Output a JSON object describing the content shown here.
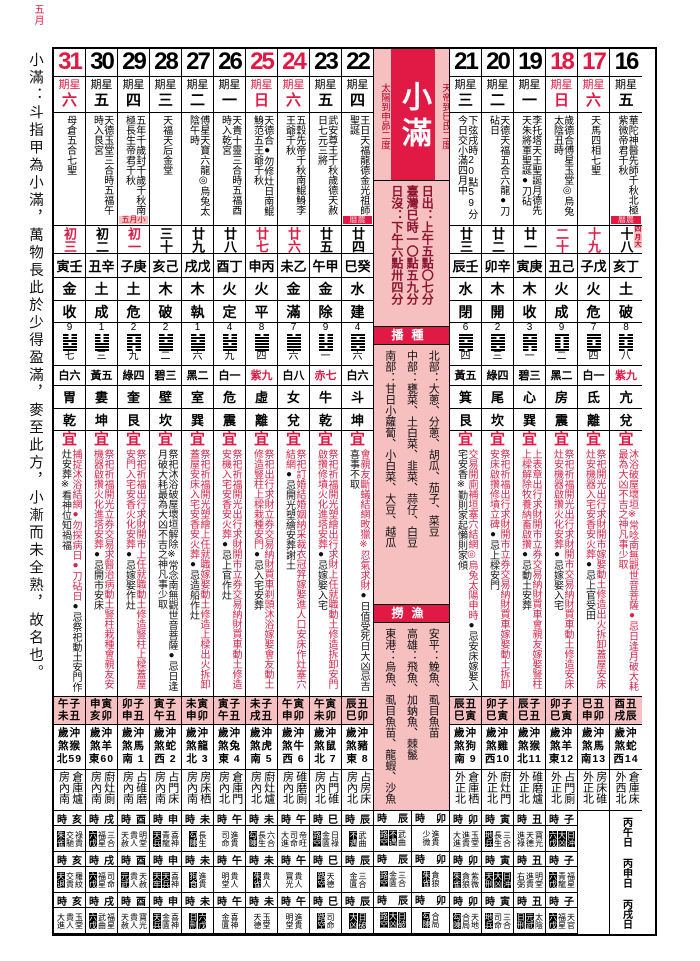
{
  "corner_label": "五月",
  "sidebar": {
    "text": "小滿：斗指甲為小滿，萬物長此於少得盈滿，麥至此方，小漸而未全熟，故名也。"
  },
  "center": {
    "title": "小滿",
    "right_label": "天帝到巳氐二度",
    "left_label": "太陽到申昴二度",
    "sun_lines": [
      "日出：上午五點〇七分",
      "臺灣巳時一〇點五九分",
      "日沒：下午六點卅四分"
    ],
    "sow_header": "播種",
    "crops": [
      "北部：大蔥、分蔥、胡瓜、茄子、菜豆",
      "中部：甕菜、土白菜、韭菜、蒜仔、白豆",
      "南部：甘日小蘿蔔、小白菜、大豆、越瓜"
    ],
    "fish_header": "撈漁",
    "fish": [
      "安平：鮸魚、虱目魚苗",
      "高雄：飛魚、加蚋魚、棘鬣",
      "東港：烏魚、虱目魚苗、龍蝦、沙魚"
    ],
    "bottom": [
      {
        "hour": "辰",
        "bands": [
          [
            "路空",
            "不遇",
            "武曲"
          ],
          [
            "路空",
            "金匱",
            "三合"
          ],
          [
            "路空",
            "大凶",
            "日破"
          ]
        ]
      },
      {
        "hour": "卯",
        "bands": [
          [
            "少微",
            "進貴"
          ],
          [
            "朱雀",
            "貪狼"
          ],
          [
            "勾陳",
            "合局"
          ]
        ]
      }
    ]
  },
  "inauspicious_stars": [
    "朱雀",
    "天兵",
    "天牢",
    "元武",
    "勾陳",
    "日刑",
    "狗食",
    "路空",
    "不遇",
    "大凶",
    "日破",
    "日沖",
    "天刑",
    "地兵",
    "天退",
    "六戊"
  ],
  "columns": [
    {
      "date": "31",
      "weekday": "六",
      "red": true,
      "festivals": "母倉五合七聖",
      "tag": null,
      "lunar": "初三",
      "lunar_red": true,
      "ganzhi": "寅壬",
      "element": "金",
      "officer": "收",
      "num": "9",
      "hex_num": "七",
      "star": "白六",
      "star_red": false,
      "mansion": "胃",
      "trigram": "乾",
      "yi_r": "捕捉沐浴結網●勿探病日●刀砧日",
      "yi_b": "●忌祭祀動土安門作灶安葬※看神位知禍福",
      "jishi": [
        "午子",
        "未丑"
      ],
      "chong": [
        "歲沖",
        "煞猴",
        "北59"
      ],
      "taishen": "倉庫爐房內南",
      "hour": "亥",
      "bands": [
        [
          "朱雀",
          "交馳",
          "祿貴"
        ],
        [
          "天退",
          "交貴",
          "羅紋"
        ],
        [
          "大進",
          "貴人",
          "玉堂"
        ]
      ]
    },
    {
      "date": "30",
      "weekday": "五",
      "red": false,
      "festivals": "天德玉堂三合時五福午時入艮宮",
      "tag": null,
      "lunar": "初二",
      "lunar_red": false,
      "ganzhi": "丑辛",
      "element": "土",
      "officer": "成",
      "num": "1",
      "hex_num": "三",
      "star": "黃五",
      "star_red": false,
      "mansion": "婁",
      "trigram": "坤",
      "yi_r": "祭祀祈福開光立券交易求醫治病動土豎柱栽種會親友安機器啟攢火化進塔安葬",
      "yi_b": "●忌開市安床",
      "jishi": [
        "申寅",
        "亥卯"
      ],
      "chong": [
        "歲沖",
        "煞羊",
        "東60"
      ],
      "taishen": "廚灶廁房內南",
      "hour": "戌",
      "bands": [
        [
          "六戊",
          "福星",
          "三合"
        ],
        [
          "六戊",
          "福星",
          "司命"
        ],
        [
          "六戊",
          "武曲",
          "福星"
        ]
      ]
    },
    {
      "date": "29",
      "weekday": "四",
      "red": false,
      "festivals": "五年千歲封千歲千秋南極長生帝君千秋",
      "tag": {
        "text": "五月小",
        "type": "month"
      },
      "lunar": "初一",
      "lunar_red": true,
      "ganzhi": "子庚",
      "element": "土",
      "officer": "危",
      "num": "2",
      "hex_num": "九",
      "star": "綠四",
      "star_red": false,
      "mansion": "奎",
      "trigram": "艮",
      "yi_r": "祭祀祈福出行求財開市上任就職動土修造豎柱上樑蓋屋安門入宅安香火化安葬",
      "yi_b": "●忌嫁娶作灶",
      "jishi": [
        "卯子",
        "申丑"
      ],
      "chong": [
        "歲沖",
        "煞馬",
        "南 1"
      ],
      "taishen": "占碓磨房內南",
      "hour": "酉",
      "bands": [
        [
          "天赦",
          "貴人",
          "明堂"
        ],
        [
          "元武",
          "貴人",
          "天赦"
        ],
        [
          "天赦",
          "貴人",
          "寶光"
        ]
      ]
    },
    {
      "date": "28",
      "weekday": "三",
      "red": false,
      "festivals": "天福天后金堂",
      "tag": null,
      "lunar": "三十",
      "lunar_red": false,
      "ganzhi": "亥己",
      "element": "木",
      "officer": "破",
      "num": "2",
      "hex_num": "二",
      "star": "碧三",
      "star_red": false,
      "mansion": "壁",
      "trigram": "坎",
      "yi_r": "",
      "yi_b": "祭祀沐浴破屋壞垣解除※常念南無觀世音菩薩●忌日逢月破大耗最為大凶不吉之神凡事少取",
      "jishi": [
        "寅子",
        "午丑"
      ],
      "chong": [
        "歲沖",
        "煞蛇",
        "西 2"
      ],
      "taishen": "占門床房內南",
      "hour": "申",
      "bands": [
        [
          "天兵",
          "青龍",
          "喜神"
        ],
        [
          "天牢",
          "天兵",
          "喜神"
        ],
        [
          "天兵",
          "金匱",
          "喜神"
        ]
      ]
    },
    {
      "date": "27",
      "weekday": "二",
      "red": false,
      "festivals": "傅星天寶六龍◎烏兔太陰午時",
      "tag": null,
      "lunar": "廿九",
      "lunar_red": false,
      "ganzhi": "戌戊",
      "element": "木",
      "officer": "執",
      "num": "1",
      "hex_num": "六",
      "star": "黑二",
      "star_red": false,
      "mansion": "室",
      "trigram": "巽",
      "yi_r": "祭祀祈福開光塑繪上任就職嫁娶動土修造上樑出火拆卸蓋屋安床入宅安香安火葬",
      "yi_b": "●忌造船作灶",
      "jishi": [
        "未寅",
        "申卯"
      ],
      "chong": [
        "歲沖",
        "煞龍",
        "北 3"
      ],
      "taishen": "房床栖房內南",
      "hour": "未",
      "bands": [
        [
          "勾陳",
          "長生"
        ],
        [
          "狗食",
          "進貴"
        ],
        [
          "日刑",
          "六戊"
        ]
      ]
    },
    {
      "date": "26",
      "weekday": "一",
      "red": false,
      "festivals": "天貴十靈三合時五福酉時入乾宮",
      "tag": null,
      "lunar": "廿八",
      "lunar_red": false,
      "ganzhi": "酉丁",
      "element": "火",
      "officer": "定",
      "num": "4",
      "hex_num": "九",
      "star": "白一",
      "star_red": false,
      "mansion": "危",
      "trigram": "震",
      "yi_r": "祭祀祈福開光出行求財開市立券交易納財買車動土修造安機入宅安香安火葬",
      "yi_b": "●忌上官作灶",
      "jishi": [
        "寅子",
        "午丑"
      ],
      "chong": [
        "歲沖",
        "煞兔",
        "東 4"
      ],
      "taishen": "倉庫門房內北",
      "hour": "午",
      "bands": [
        [
          "司命",
          "進貴"
        ],
        [
          "明堂",
          "貴人"
        ],
        [
          "金匱",
          "喜神"
        ]
      ]
    },
    {
      "date": "25",
      "weekday": "日",
      "red": true,
      "festivals": "天德合●勿修灶日南鯤鯓范五王爺千秋",
      "tag": null,
      "lunar": "廿七",
      "lunar_red": true,
      "ganzhi": "申丙",
      "element": "火",
      "officer": "平",
      "num": "8",
      "hex_num": "四",
      "star": "紫九",
      "star_red": true,
      "mansion": "虛",
      "trigram": "離",
      "yi_r": "祭祀出行求財立券交易納財買車剃頭沐浴嫁娶會友動土修造豎柱上樑栽種安門",
      "yi_b": "●忌入宅安葬",
      "jishi": [
        "未子",
        "戌丑"
      ],
      "chong": [
        "歲沖",
        "煞虎",
        "南 5"
      ],
      "taishen": "廚灶爐房內北",
      "hour": "未",
      "bands": [
        [
          "勾陳",
          "長生",
          "六合"
        ],
        [
          "朱雀",
          "貴人"
        ],
        [
          "天德",
          "玉堂"
        ]
      ]
    },
    {
      "date": "24",
      "weekday": "六",
      "red": true,
      "festivals": "五穀先帝千秋南鯤鯓李王爺千秋",
      "tag": null,
      "lunar": "廿六",
      "lunar_red": true,
      "ganzhi": "未乙",
      "element": "金",
      "officer": "滿",
      "num": "7",
      "hex_num": "六",
      "star": "白八",
      "star_red": false,
      "mansion": "女",
      "trigram": "兌",
      "yi_r": "祭祀訂婚結婚姻納采裁衣冠笄嫁娶進人口安床作灶塞穴結網",
      "yi_b": "●忌開光塑繪安葬謝土",
      "jishi": [
        "午寅",
        "申卯"
      ],
      "chong": [
        "歲沖",
        "煞牛",
        "西 6"
      ],
      "taishen": "碓磨廁房內北",
      "hour": "午",
      "bands": [
        [
          "大進",
          "司命",
          "帝旺"
        ],
        [
          "寶光",
          "貴人"
        ],
        [
          "明堂",
          "進貴"
        ]
      ]
    },
    {
      "date": "23",
      "weekday": "五",
      "red": false,
      "festivals": "武安尊王千秋歲德天赦日七元三將",
      "tag": null,
      "lunar": "廿五",
      "lunar_red": false,
      "ganzhi": "午甲",
      "element": "金",
      "officer": "除",
      "num": "9",
      "hex_num": "一",
      "star": "赤七",
      "star_red": true,
      "mansion": "牛",
      "trigram": "乾",
      "yi_r": "祭祀祈福開光塑繪出行求財上任就職動土修造拆卸安門啟攢修墳火化進塔安葬",
      "yi_b": "●忌嫁娶入宅",
      "jishi": [
        "午寅",
        "未卯"
      ],
      "chong": [
        "歲沖",
        "煞鼠",
        "北 7"
      ],
      "taishen": "占門碓房內北",
      "hour": "巳",
      "bands": [
        [
          "路空",
          "金匱",
          "日祿"
        ],
        [
          "路空",
          "天德"
        ],
        [
          "路空",
          "司命"
        ]
      ]
    },
    {
      "date": "22",
      "weekday": "四",
      "red": false,
      "festivals": "王日天福龍德金光祖師聖誕",
      "tag": {
        "text": "曆農",
        "type": "almanac"
      },
      "lunar": "廿四",
      "lunar_red": false,
      "ganzhi": "巳癸",
      "element": "水",
      "officer": "建",
      "num": "4",
      "hex_num": "六",
      "star": "白六",
      "star_red": false,
      "mansion": "斗",
      "trigram": "坤",
      "yi_r": "會親友斷蟻結網畋獵※忍氣求財",
      "yi_b": "●日值受死日大凶忌吉喜事不取",
      "jishi": [
        "辰丑",
        "巳卯"
      ],
      "chong": [
        "歲沖",
        "煞豬",
        "東 8"
      ],
      "taishen": "占房床房內北",
      "hour": "辰",
      "bands": [
        [
          "不遇",
          "武曲"
        ],
        [
          "金匱",
          "三合"
        ],
        [
          "大凶",
          "日破"
        ]
      ]
    },
    {
      "date": "21",
      "weekday": "三",
      "red": false,
      "festivals": "下弦戌時20點59分今日交小滿四月中",
      "tag": null,
      "lunar": "廿三",
      "lunar_red": false,
      "ganzhi": "辰壬",
      "element": "水",
      "officer": "閉",
      "num": "6",
      "hex_num": "四",
      "star": "黃五",
      "star_red": false,
      "mansion": "箕",
      "trigram": "艮",
      "yi_r": "交易開廁補垣塞穴結網◎烏兔太陽申時",
      "yi_b": "●忌安床嫁娶入宅安香※勤則家起懶則家傾",
      "jishi": [
        "辰丑",
        "巳寅"
      ],
      "chong": [
        "歲沖",
        "煞狗",
        "南 9"
      ],
      "taishen": "倉庫栖外正北",
      "hour": "卯",
      "bands": [
        [
          "大進",
          "進貴",
          "玉堂"
        ],
        [
          "朱雀",
          "貪狼",
          "紫微"
        ],
        [
          "勾陳",
          "合局",
          "天地"
        ]
      ]
    },
    {
      "date": "20",
      "weekday": "二",
      "red": false,
      "festivals": "天德天福五合六龍●刀砧日",
      "tag": null,
      "lunar": "廿二",
      "lunar_red": false,
      "ganzhi": "卯辛",
      "element": "木",
      "officer": "開",
      "num": "2",
      "hex_num": "三",
      "star": "綠四",
      "star_red": false,
      "mansion": "尾",
      "trigram": "坎",
      "yi_r": "祭祀祈福出行求財開市立券交易納財買車嫁娶動土拆卸安床啟攢修墳立碑",
      "yi_b": "●忌上樑安門",
      "jishi": [
        "卯子",
        "巳寅"
      ],
      "chong": [
        "歲沖",
        "煞雞",
        "西10"
      ],
      "taishen": "廚灶門外正北",
      "hour": "寅",
      "bands": [
        [
          "地兵",
          "長生",
          "三合"
        ],
        [
          "天刑",
          "大凶",
          "日沖"
        ],
        [
          "地兵",
          "司命",
          "三合"
        ]
      ]
    },
    {
      "date": "19",
      "weekday": "一",
      "red": false,
      "festivals": "李托塔天王聖誕月德先天朱將軍聖誕●刀砧",
      "tag": null,
      "lunar": "廿一",
      "lunar_red": false,
      "ganzhi": "寅庚",
      "element": "木",
      "officer": "收",
      "num": "3",
      "hex_num": "一",
      "star": "碧三",
      "star_red": false,
      "mansion": "心",
      "trigram": "巽",
      "yi_r": "上表章出行求財開市立券交易納財買車會親友嫁娶豎柱上樑解除牧養納畜啟攢",
      "yi_b": "●忌動土安葬",
      "jishi": [
        "辰子",
        "巳丑"
      ],
      "chong": [
        "歲沖",
        "煞猴",
        "北11"
      ],
      "taishen": "碓磨爐外正北",
      "hour": "丑",
      "bands": [
        [
          "進祿",
          "天德",
          "寶光"
        ],
        [
          "右弼",
          "進貴",
          "明堂"
        ],
        [
          "日刑",
          "元武",
          "太陰"
        ]
      ]
    },
    {
      "date": "18",
      "weekday": "日",
      "red": true,
      "festivals": "歲德合傅星玉堂◎烏兔太陰丑時",
      "tag": null,
      "lunar": "二十",
      "lunar_red": true,
      "ganzhi": "丑己",
      "element": "火",
      "officer": "成",
      "num": "9",
      "hex_num": "二",
      "star": "黑二",
      "star_red": false,
      "mansion": "房",
      "trigram": "震",
      "yi_r": "祭祀祈福開光出行求財開市交易納財買車動土修造安床灶安機器啟攢火化安葬",
      "yi_b": "●忌嫁娶入宅",
      "jishi": [
        "卯子",
        "巳寅"
      ],
      "chong": [
        "歲沖",
        "煞羊",
        "東12"
      ],
      "taishen": "占門廁外正北",
      "hour": "子",
      "bands": [
        [
          "六戊",
          "大凶",
          "日沖"
        ],
        [
          "六戊",
          "青龍",
          "福星"
        ],
        [
          "六戊",
          "福星",
          "天官"
        ]
      ]
    },
    {
      "date": "17",
      "weekday": "六",
      "red": true,
      "festivals": "天馬四相七聖",
      "tag": null,
      "lunar": "十九",
      "lunar_red": true,
      "ganzhi": "子戊",
      "element": "火",
      "officer": "危",
      "num": "7",
      "hex_num": "四",
      "star": "白一",
      "star_red": false,
      "mansion": "氐",
      "trigram": "離",
      "yi_r": "祭祀開光出行求財開市嫁娶動土修造出火拆卸蓋屋安床灶安機器入宅安香安火葬",
      "yi_b": "●忌上官受田",
      "jishi": [
        "巳丑",
        "申卯"
      ],
      "chong": [
        "歲沖",
        "煞馬",
        "南13"
      ],
      "taishen": "房床碓外正北",
      "hour": null,
      "bands": null
    },
    {
      "date": "16",
      "weekday": "五",
      "red": false,
      "festivals": "華陀神醫先師千秋北極紫微帝君千秋",
      "tag": {
        "text": "曆農",
        "type": "almanac"
      },
      "tag2": {
        "text": "四月大",
        "type": "month"
      },
      "lunar": "十八",
      "lunar_red": false,
      "ganzhi": "亥丁",
      "element": "土",
      "officer": "破",
      "num": "8",
      "hex_num": "八",
      "star": "紫九",
      "star_red": true,
      "mansion": "亢",
      "trigram": "兌",
      "yi_r": "沐浴破屋壞垣※常唸南無觀世音菩薩●忌日逢月破大耗最為大凶不吉之神凡事少取",
      "yi_b": "",
      "jishi": [
        "酉丑",
        "戌辰"
      ],
      "chong": [
        "歲沖",
        "煞蛇",
        "西14"
      ],
      "taishen": "倉庫床外西北",
      "hour": null,
      "bands": null,
      "merged_labels": [
        "丙午日",
        "丙申日",
        "丙戌日"
      ]
    }
  ]
}
